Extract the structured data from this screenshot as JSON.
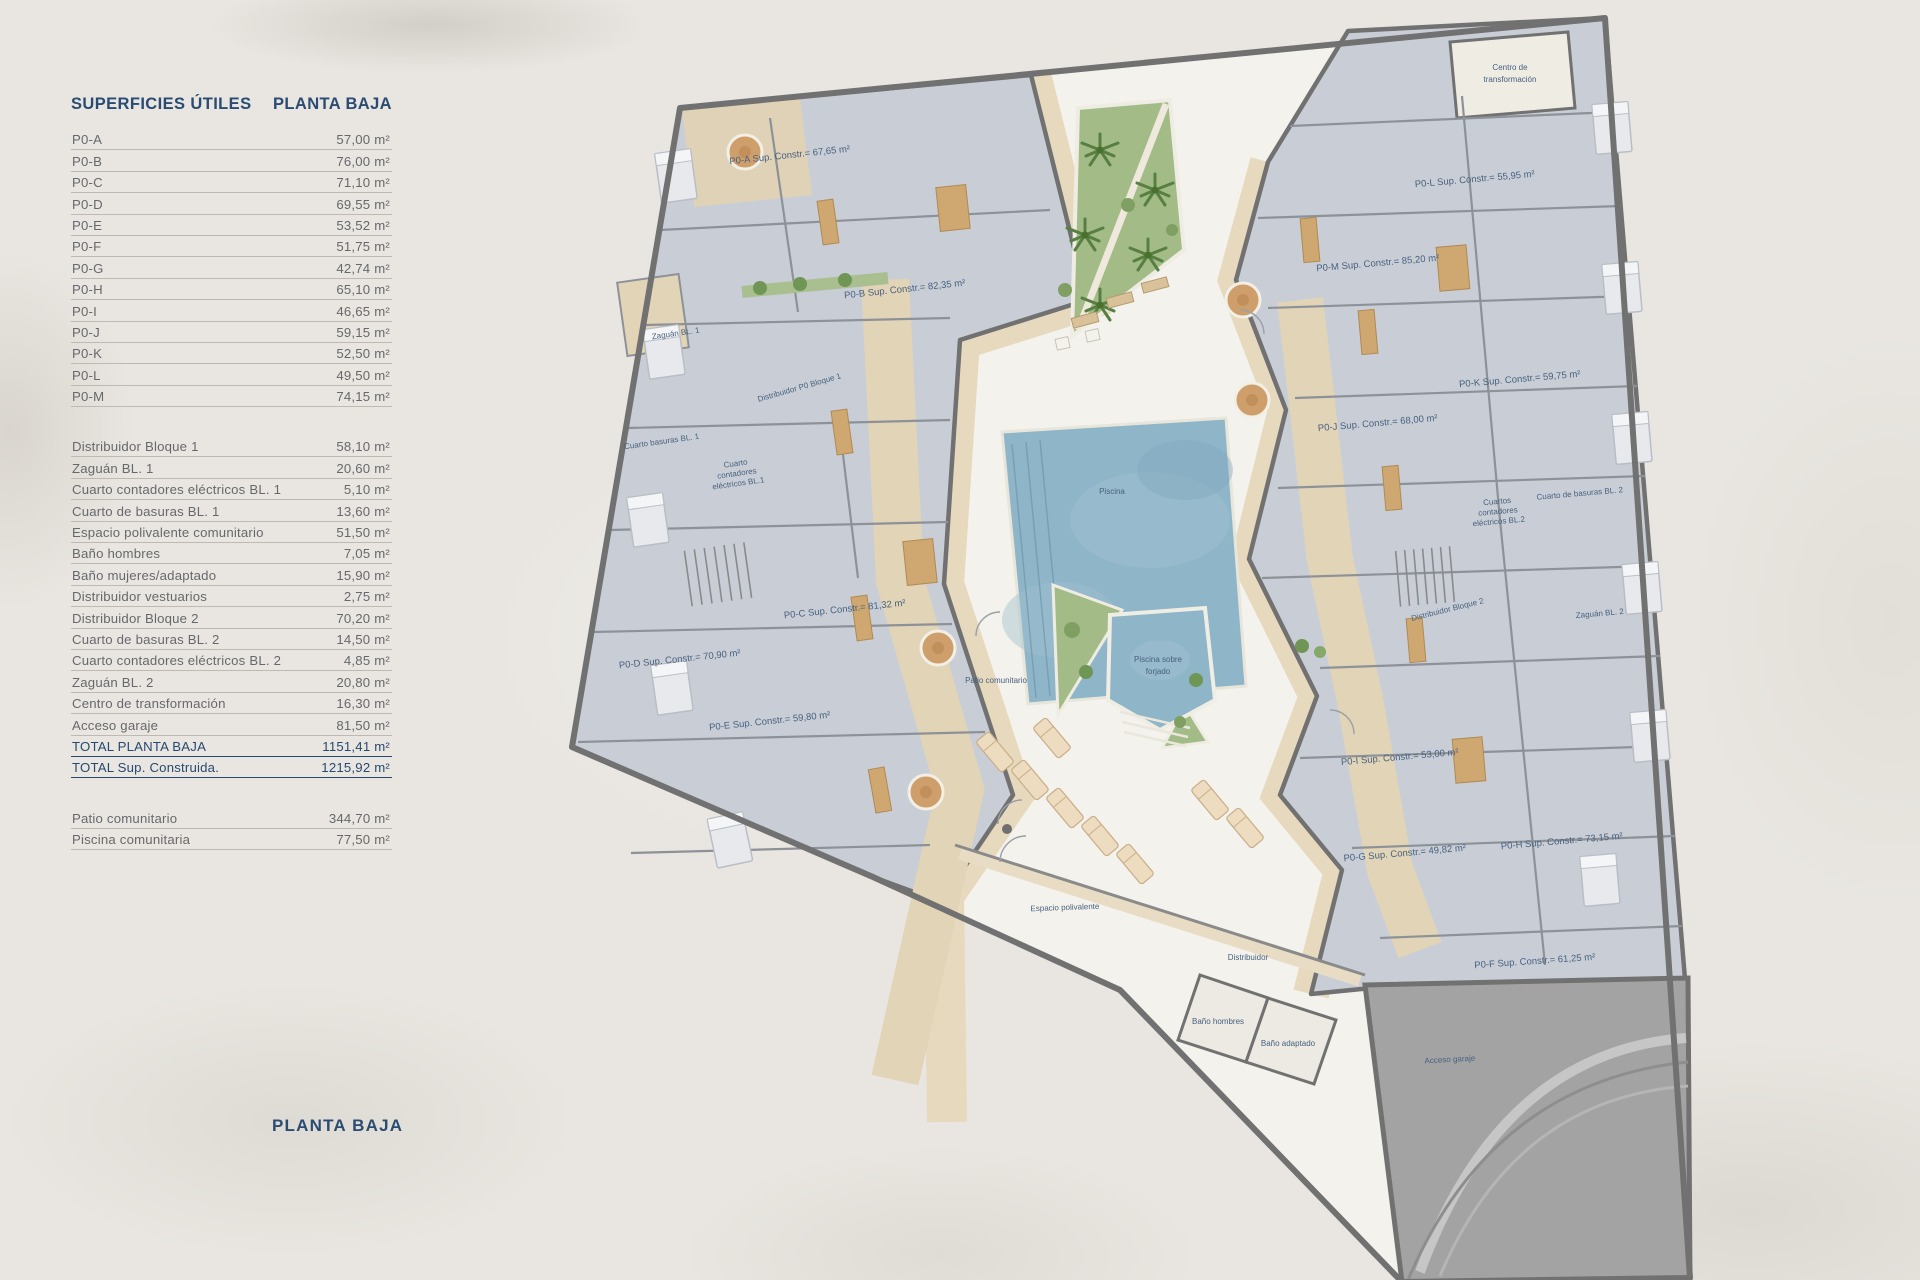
{
  "sidebar": {
    "title_left": "SUPERFICIES ÚTILES",
    "title_right": "PLANTA BAJA",
    "unit_rows": [
      {
        "label": "P0-A",
        "value": "57,00 m²"
      },
      {
        "label": "P0-B",
        "value": "76,00 m²"
      },
      {
        "label": "P0-C",
        "value": "71,10 m²"
      },
      {
        "label": "P0-D",
        "value": "69,55 m²"
      },
      {
        "label": "P0-E",
        "value": "53,52 m²"
      },
      {
        "label": "P0-F",
        "value": "51,75 m²"
      },
      {
        "label": "P0-G",
        "value": "42,74 m²"
      },
      {
        "label": "P0-H",
        "value": "65,10 m²"
      },
      {
        "label": "P0-I",
        "value": "46,65 m²"
      },
      {
        "label": "P0-J",
        "value": "59,15 m²"
      },
      {
        "label": "P0-K",
        "value": "52,50 m²"
      },
      {
        "label": "P0-L",
        "value": "49,50 m²"
      },
      {
        "label": "P0-M",
        "value": "74,15 m²"
      }
    ],
    "common_rows": [
      {
        "label": "Distribuidor Bloque 1",
        "value": "58,10 m²"
      },
      {
        "label": "Zaguán BL. 1",
        "value": "20,60 m²"
      },
      {
        "label": "Cuarto contadores eléctricos BL. 1",
        "value": "5,10 m²"
      },
      {
        "label": "Cuarto de basuras BL. 1",
        "value": "13,60 m²"
      },
      {
        "label": "Espacio polivalente comunitario",
        "value": "51,50 m²"
      },
      {
        "label": "Baño hombres",
        "value": "7,05 m²"
      },
      {
        "label": "Baño mujeres/adaptado",
        "value": "15,90 m²"
      },
      {
        "label": "Distribuidor vestuarios",
        "value": "2,75 m²"
      },
      {
        "label": "Distribuidor Bloque 2",
        "value": "70,20 m²"
      },
      {
        "label": "Cuarto de basuras BL. 2",
        "value": "14,50 m²"
      },
      {
        "label": "Cuarto contadores eléctricos BL. 2",
        "value": "4,85 m²"
      },
      {
        "label": "Zaguán BL. 2",
        "value": "20,80 m²"
      },
      {
        "label": "Centro de transformación",
        "value": "16,30 m²"
      },
      {
        "label": "Acceso garaje",
        "value": "81,50 m²"
      },
      {
        "label": "TOTAL PLANTA BAJA",
        "value": "1151,41 m²",
        "total": true
      },
      {
        "label": "TOTAL Sup. Construida.",
        "value": "1215,92 m²",
        "total": true
      }
    ],
    "outdoor_rows": [
      {
        "label": "Patio comunitario",
        "value": "344,70 m²"
      },
      {
        "label": "Piscina comunitaria",
        "value": "77,50 m²"
      }
    ],
    "footer_title": "PLANTA BAJA"
  },
  "plan": {
    "labels": {
      "p0a": "P0-A Sup. Constr.= 67,65 m²",
      "p0b": "P0-B Sup. Constr.= 82,35 m²",
      "p0c": "P0-C Sup. Constr.= 81,32 m²",
      "p0d": "P0-D Sup. Constr.= 70,90 m²",
      "p0e": "P0-E Sup. Constr.= 59,80 m²",
      "p0f": "P0-F Sup. Constr.= 61,25 m²",
      "p0g": "P0-G Sup. Constr.= 49,82 m²",
      "p0h": "P0-H Sup. Constr.= 73,15 m²",
      "p0i": "P0-I Sup. Constr.= 53,00 m²",
      "p0j": "P0-J Sup. Constr.= 68,00 m²",
      "p0k": "P0-K Sup. Constr.= 59,75 m²",
      "p0l": "P0-L Sup. Constr.= 55,95 m²",
      "p0m": "P0-M Sup. Constr.= 85,20 m²",
      "zaguan1": "Zaguán BL. 1",
      "dist_bloque1": "Distribuidor P0 Bloque 1",
      "cuarto_basuras1": "Cuarto basuras BL. 1",
      "cce1_l1": "Cuarto",
      "cce1_l2": "contadores",
      "cce1_l3": "eléctricos BL.1",
      "piscina": "Piscina",
      "patio": "Patio comunitario",
      "psf_l1": "Piscina sobre",
      "psf_l2": "forjado",
      "espacio": "Espacio polivalente",
      "distribuidor": "Distribuidor",
      "bano_hombres": "Baño hombres",
      "bano_adaptado": "Baño adaptado",
      "acceso_garaje": "Acceso garaje",
      "cdt_l1": "Centro de",
      "cdt_l2": "transformación",
      "cdb2": "Cuarto de basuras BL. 2",
      "cce2_l1": "Cuartos",
      "cce2_l2": "contadores",
      "cce2_l3": "eléctricos BL.2",
      "dist_bloque2": "Distribuidor Bloque 2",
      "zaguan2": "Zaguán BL. 2"
    },
    "colors": {
      "courtyard": "#f4f2ec",
      "rooms": "#c9ced6",
      "corridor": "#e2d4b6",
      "terrace": "#e6d9be",
      "walls": "#717171",
      "garden": "#a3bb87",
      "pool": "#8eb5c8",
      "garage": "#a3a3a3",
      "label_navy": "#47617f"
    }
  }
}
